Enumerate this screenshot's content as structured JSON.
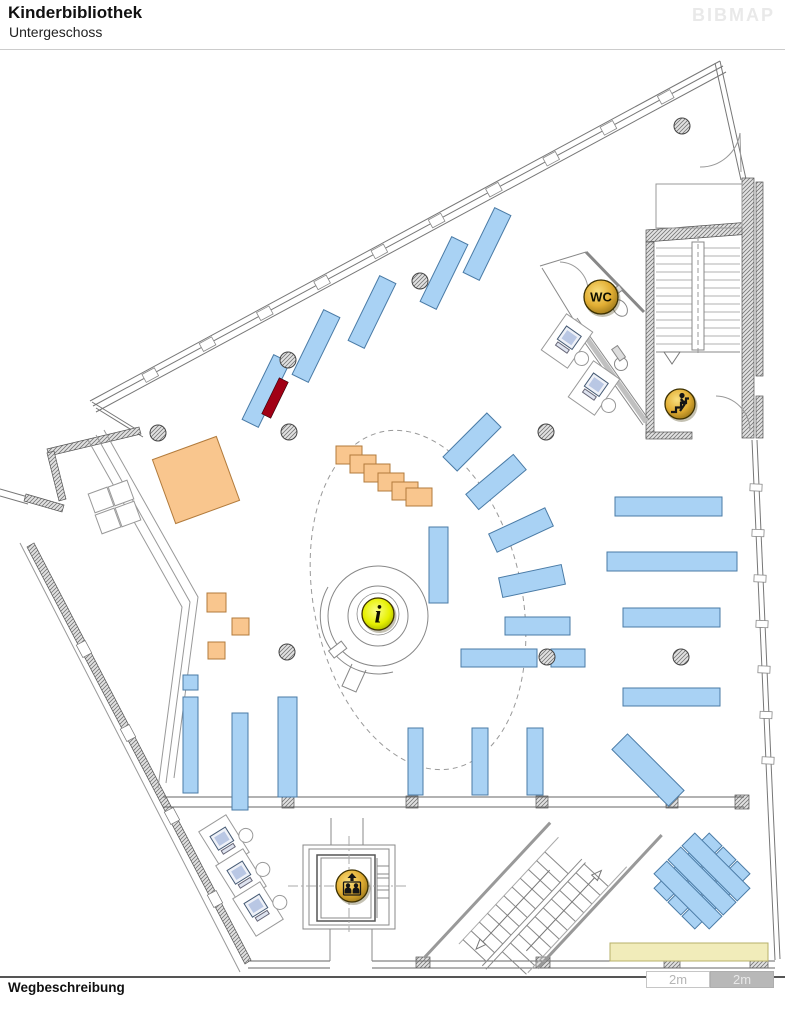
{
  "header": {
    "title": "Kinderbibliothek",
    "subtitle": "Untergeschoss",
    "logo": "BIBMAP"
  },
  "footer": {
    "label": "Wegbeschreibung"
  },
  "scalebar": {
    "segments": [
      {
        "label": "2m"
      },
      {
        "label": "2m"
      }
    ]
  },
  "colors": {
    "shelf": "#a9d2f4",
    "shelfStroke": "#4a7ba6",
    "highlight": "#a10015",
    "furniture": "#f9c68e",
    "furnitureStroke": "#b27b3c",
    "bench": "#f1ecba",
    "benchStroke": "#b7b06a",
    "gold": [
      "#f8de7e",
      "#e2ae33",
      "#8f6e16"
    ],
    "info": [
      "#fbff85",
      "#e6f000",
      "#99a800"
    ]
  },
  "map": {
    "icons": [
      {
        "name": "wc",
        "type": "text",
        "label": "WC",
        "x": 601,
        "y": 297,
        "r": 17
      },
      {
        "name": "stairs-up",
        "type": "stairs",
        "x": 680,
        "y": 404,
        "r": 15
      },
      {
        "name": "elevator",
        "type": "elevator",
        "x": 352,
        "y": 886,
        "r": 16
      },
      {
        "name": "info",
        "type": "info",
        "label": "i",
        "x": 378,
        "y": 614,
        "r": 16
      }
    ],
    "shelves": [
      [
        257,
        355,
        18,
        72,
        26
      ],
      [
        307,
        310,
        18,
        72,
        26
      ],
      [
        363,
        276,
        18,
        72,
        26
      ],
      [
        435,
        237,
        18,
        72,
        26
      ],
      [
        478,
        208,
        18,
        72,
        26
      ],
      [
        462,
        411,
        20,
        62,
        45
      ],
      [
        486,
        451,
        20,
        62,
        50
      ],
      [
        511,
        499,
        20,
        62,
        65
      ],
      [
        522,
        549,
        20,
        64,
        78
      ],
      [
        505,
        617,
        65,
        18,
        0
      ],
      [
        461,
        649,
        76,
        18,
        0
      ],
      [
        551,
        649,
        34,
        18,
        0
      ],
      [
        429,
        527,
        19,
        76,
        0
      ],
      [
        615,
        497,
        107,
        19,
        0
      ],
      [
        607,
        552,
        130,
        19,
        0
      ],
      [
        623,
        608,
        97,
        19,
        0
      ],
      [
        623,
        688,
        97,
        18,
        0
      ],
      [
        183,
        675,
        15,
        15,
        0
      ],
      [
        183,
        697,
        15,
        96,
        0
      ],
      [
        232,
        713,
        16,
        97,
        0
      ],
      [
        278,
        697,
        19,
        100,
        0
      ],
      [
        408,
        728,
        15,
        67,
        0
      ],
      [
        472,
        728,
        16,
        67,
        0
      ],
      [
        527,
        728,
        16,
        67,
        0
      ],
      [
        637,
        730,
        22,
        80,
        -45
      ],
      [
        679,
        828,
        18,
        78,
        45
      ],
      [
        693,
        842,
        18,
        78,
        45
      ],
      [
        707,
        856,
        18,
        78,
        45
      ],
      [
        679,
        856,
        18,
        78,
        -45
      ],
      [
        693,
        842,
        18,
        78,
        -45
      ],
      [
        707,
        828,
        18,
        78,
        -45
      ]
    ],
    "highlight": [
      270,
      378,
      10,
      40,
      26
    ],
    "orange": [
      [
        162,
        446,
        68,
        68,
        -20
      ],
      [
        207,
        593,
        19,
        19,
        0
      ],
      [
        232,
        618,
        17,
        17,
        0
      ],
      [
        208,
        642,
        17,
        17,
        0
      ]
    ],
    "steps": [
      [
        336,
        446
      ],
      [
        350,
        455
      ],
      [
        364,
        464
      ],
      [
        378,
        473
      ],
      [
        392,
        482
      ],
      [
        406,
        488
      ]
    ],
    "bench": [
      610,
      943,
      158,
      18
    ],
    "columns": [
      [
        420,
        281
      ],
      [
        288,
        360
      ],
      [
        289,
        432
      ],
      [
        158,
        433
      ],
      [
        287,
        652
      ],
      [
        546,
        432
      ],
      [
        547,
        657
      ],
      [
        681,
        657
      ],
      [
        682,
        126
      ]
    ],
    "computers": [
      [
        567,
        341,
        35
      ],
      [
        594,
        388,
        35
      ],
      [
        224,
        842,
        -32
      ],
      [
        241,
        876,
        -32
      ],
      [
        258,
        909,
        -32
      ]
    ]
  }
}
